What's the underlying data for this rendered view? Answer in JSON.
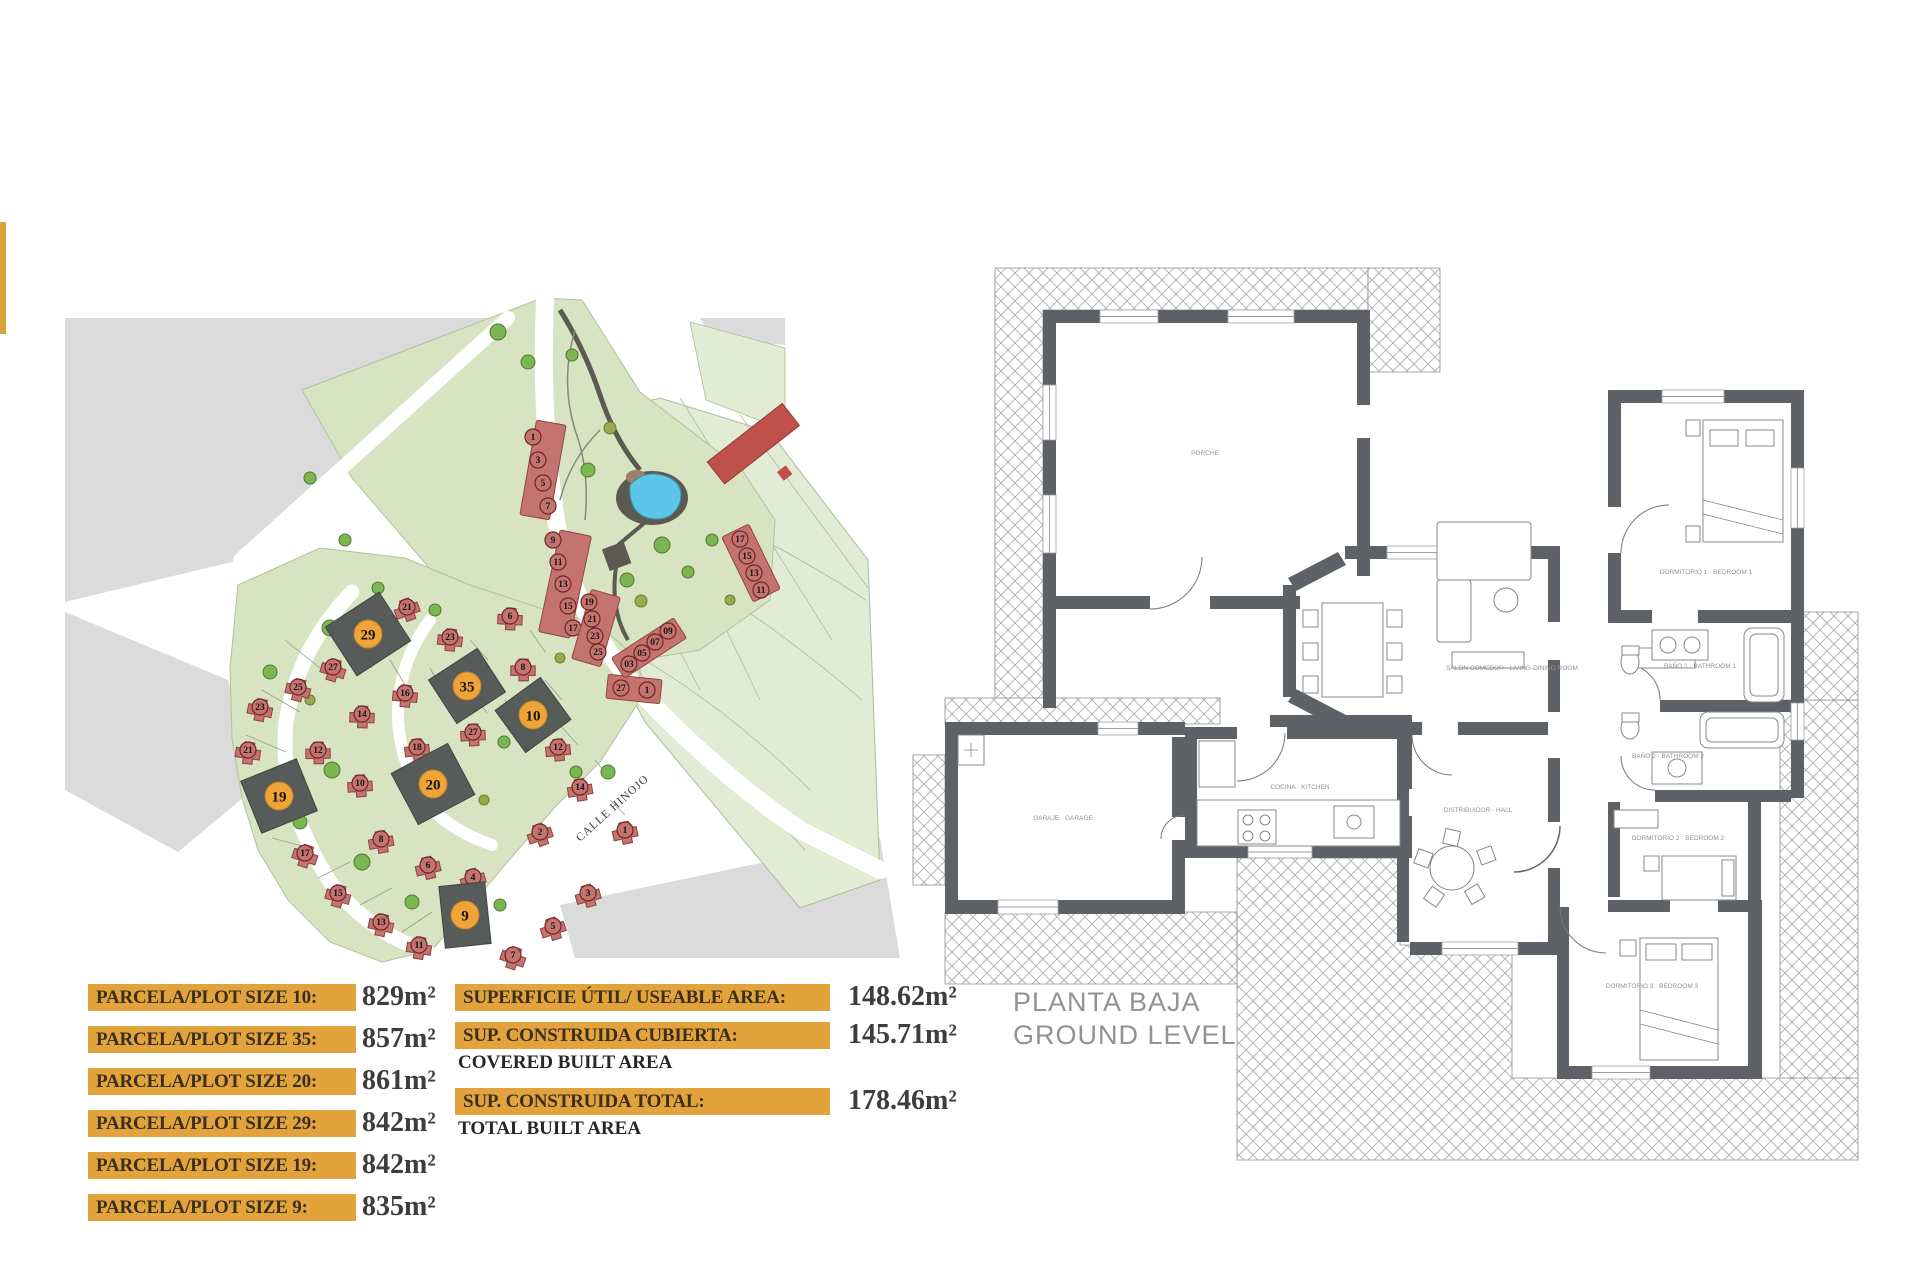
{
  "page": {
    "bg": "#ffffff"
  },
  "accent_bar": {
    "color": "#D9A33C"
  },
  "site_plan": {
    "street_label": "CALLE HINOJO",
    "colors": {
      "road": "#DBDBDB",
      "green": "#D7E3C1",
      "green_pale": "#E2EBD3",
      "house": "#C4736E",
      "house_edge": "#8F4742",
      "highlight_plot": "#575C5B",
      "highlight_circle": "#F0A437",
      "pool": "#5CC6E8",
      "pool_deck": "#5C5A50",
      "tree": "#7CB652",
      "tree_edge": "#4E7A33",
      "tree_olive": "#9AA94C",
      "tree_olive_edge": "#6E7A2E",
      "path": "#5C5A50",
      "building": "#C0504A"
    },
    "highlighted_plots": [
      "29",
      "35",
      "10",
      "20",
      "19",
      "9"
    ],
    "row_strips": [
      [
        "1",
        "3",
        "5",
        "7"
      ],
      [
        "9",
        "11",
        "13",
        "15",
        "17"
      ],
      [
        "19",
        "21",
        "23",
        "25"
      ],
      [
        "27",
        "1"
      ],
      [
        "17",
        "15",
        "13",
        "11"
      ],
      [
        "09",
        "07",
        "05",
        "03"
      ]
    ],
    "detached_plots": [
      "21",
      "27",
      "25",
      "23",
      "21",
      "16",
      "14",
      "12",
      "10",
      "18",
      "8",
      "6",
      "4",
      "2",
      "17",
      "15",
      "13",
      "11",
      "23",
      "6",
      "8",
      "27",
      "12",
      "14",
      "1",
      "3",
      "5",
      "7"
    ]
  },
  "floor_plan": {
    "title_line1": "PLANTA BAJA",
    "title_line2": "GROUND LEVEL",
    "wall_color": "#5E6266",
    "rooms": {
      "porch": "PORCHE",
      "living": "SALÓN COMEDOR · LIVING-DINING ROOM",
      "kitchen": "COCINA · KITCHEN",
      "garage": "GARAJE · GARAGE",
      "hall": "DISTRIBUIDOR · HALL",
      "bedroom1": "DORMITORIO 1 · BEDROOM 1",
      "bathroom1": "BAÑO 1 · BATHROOM 1",
      "bathroom2": "BAÑO 2 · BATHROOM 2",
      "bedroom2": "DORMITORIO 2 · BEDROOM 2",
      "bedroom3": "DORMITORIO 3 · BEDROOM 3"
    }
  },
  "labels_panel": {
    "bar_color": "#E2A33C",
    "parcels": [
      {
        "label": "PARCELA/PLOT SIZE 10:",
        "value": "829m²"
      },
      {
        "label": "PARCELA/PLOT SIZE 35:",
        "value": "857m²"
      },
      {
        "label": "PARCELA/PLOT SIZE 20:",
        "value": "861m²"
      },
      {
        "label": "PARCELA/PLOT SIZE 29:",
        "value": "842m²"
      },
      {
        "label": "PARCELA/PLOT SIZE 19:",
        "value": "842m²"
      },
      {
        "label": "PARCELA/PLOT SIZE 9:",
        "value": "835m²"
      }
    ],
    "areas": [
      {
        "label": "SUPERFICIE ÚTIL/ USEABLE AREA:",
        "sublabel": "",
        "value": "148.62m²"
      },
      {
        "label": "SUP. CONSTRUIDA CUBIERTA:",
        "sublabel": "COVERED BUILT AREA",
        "value": "145.71m²"
      },
      {
        "label": "SUP. CONSTRUIDA TOTAL:",
        "sublabel": "TOTAL BUILT AREA",
        "value": "178.46m²"
      }
    ]
  }
}
